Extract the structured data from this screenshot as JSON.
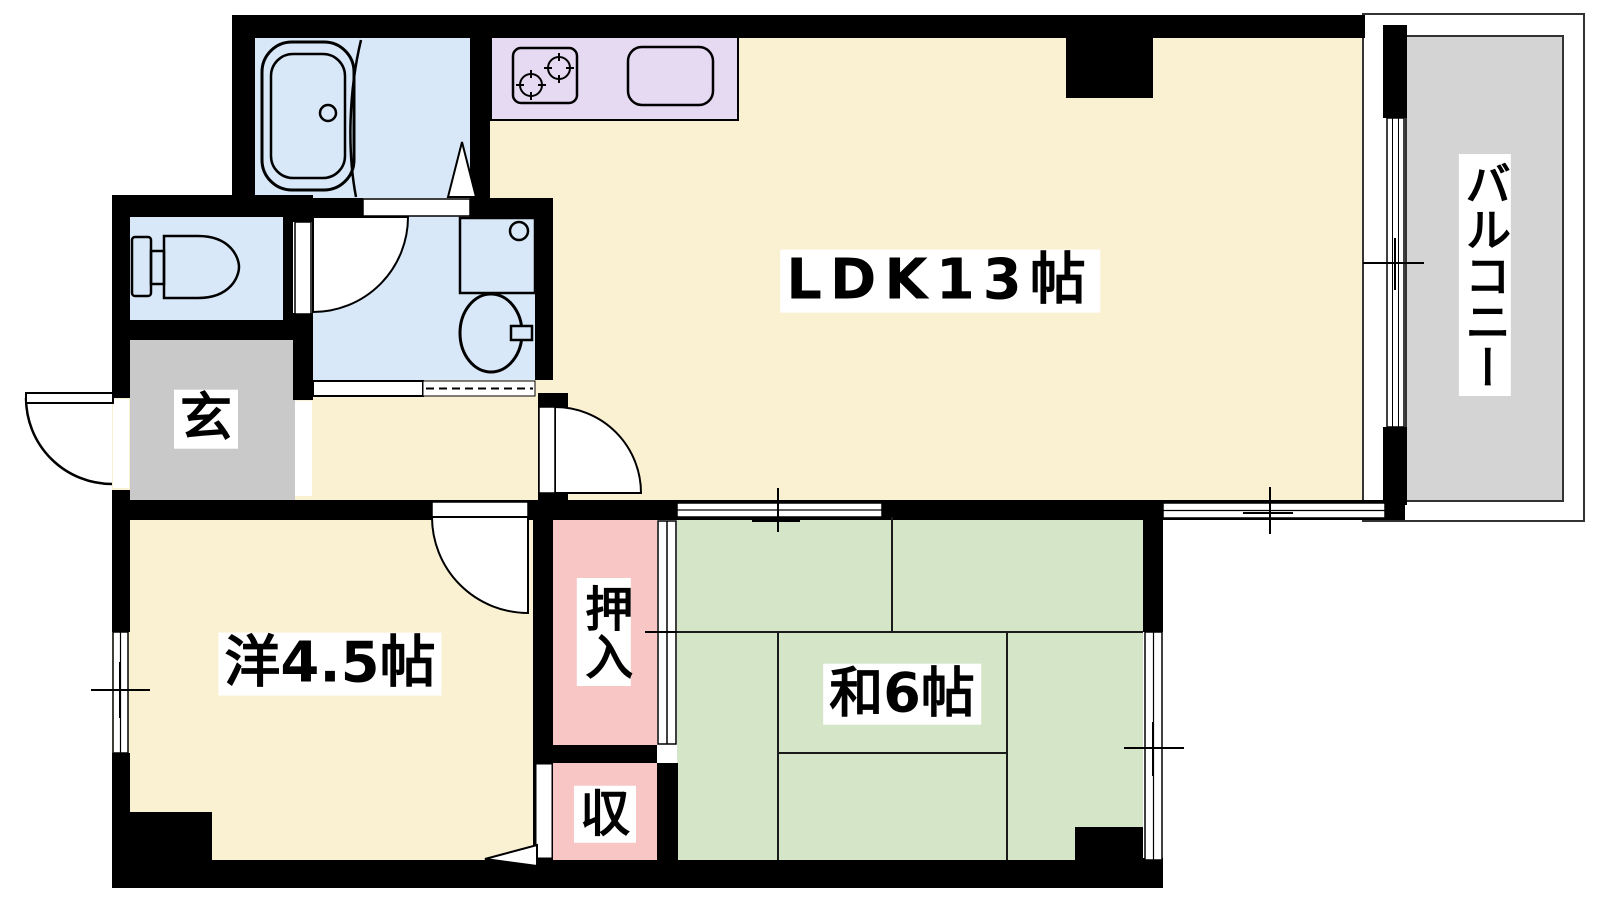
{
  "plan": {
    "type": "apartment-floor-plan",
    "rooms": {
      "ldk": {
        "label": "LDK13帖"
      },
      "balcony": {
        "label": "バルコニー"
      },
      "genkan": {
        "label": "玄"
      },
      "western": {
        "label": "洋4.5帖"
      },
      "japanese": {
        "label": "和6帖"
      },
      "oshiire": {
        "label": "押入"
      },
      "storage": {
        "label": "収"
      }
    },
    "colors": {
      "wall": "#000000",
      "ldk_floor": "#FAF0D2",
      "wet_area": "#D8E8F8",
      "kitchen_counter": "#E6D9F2",
      "closet_pink": "#F9C6C6",
      "tatami_green": "#D4E6C7",
      "genkan_gray": "#C9C9C9",
      "balcony_gray": "#D4D4D4",
      "label_bg": "#FFFFFF"
    }
  }
}
